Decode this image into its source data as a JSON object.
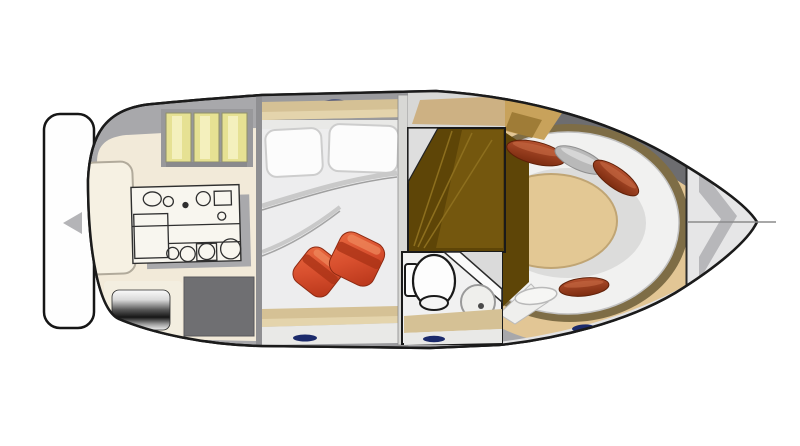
{
  "page": {
    "background": "#ffffff",
    "description": "Top-down interior deck-plan illustration of a motor yacht; bow points right, stern with swim platform on the left; no text labels rendered"
  },
  "colors": {
    "outline": "#1b1b1b",
    "deck_gray": "#a8a8ab",
    "dark_rim_gray": "#6d6d70",
    "cockpit_floor_cream": "#f2ead9",
    "cushion_yellow": "#e6e193",
    "cushion_yellow_light": "#f4f0bd",
    "cushion_backing_gray": "#98989b",
    "bench_white": "#f6f1e3",
    "engine_hatch_gray": "#6f6f72",
    "cabin_wall_gray": "#9a9a9d",
    "cabin_floor_white": "#ededee",
    "shelf_tan": "#d5c195",
    "shelf_tan_light": "#e4d4ac",
    "trim_white": "#e9e9e7",
    "pillow_white": "#fcfcfc",
    "hatch_navy": "#1b2a6b",
    "stair_wood_dark": "#5e4507",
    "stair_wood_light": "#77590f",
    "wardrobe_gold": "#c8a25b",
    "bath_floor_white": "#f1f1f1",
    "bow_ring_tan": "#e2c695",
    "bow_ring_olive": "#7e6d46",
    "seat_white": "#f1f1f0",
    "seat_inner_shadow": "#dcdcdb",
    "table_tan": "#e3c894",
    "pillow_gray": "#b9b9b9",
    "foredeck_white": "#e6e6e7",
    "anchor_locker_gray": "#b7b7ba",
    "platform_white": "#fefefe"
  },
  "areas": {
    "swim_platform": {
      "name": "swim platform at stern"
    },
    "cockpit": {
      "name": "aft cockpit",
      "items": [
        "white bench seat",
        "three yellow seat cushions",
        "hand-sketched galley unit with sink and burners",
        "metallic grill cylinder on pad",
        "dark engine hatch"
      ]
    },
    "mid_cabin": {
      "name": "mid cabin with double berth",
      "items": [
        "two white pillows",
        "folded white duvet",
        "two red accent cushions",
        "tan shelf with navy hatch top and bottom"
      ]
    },
    "companionway": {
      "name": "companionway stairs in dark wood"
    },
    "head": {
      "name": "head / bathroom",
      "items": [
        "toilet",
        "round washbasin",
        "angled shower wall"
      ]
    },
    "bow_salon": {
      "name": "bow lounge with U-shaped seating",
      "items": [
        "white horseshoe settee",
        "oval tan table area",
        "rust bolster pillows",
        "gray bolster pillow",
        "white bolster cushion",
        "gold-and-brown wardrobe bulkhead"
      ]
    },
    "foredeck": {
      "name": "foredeck with anchor locker chevron and centerline"
    }
  }
}
